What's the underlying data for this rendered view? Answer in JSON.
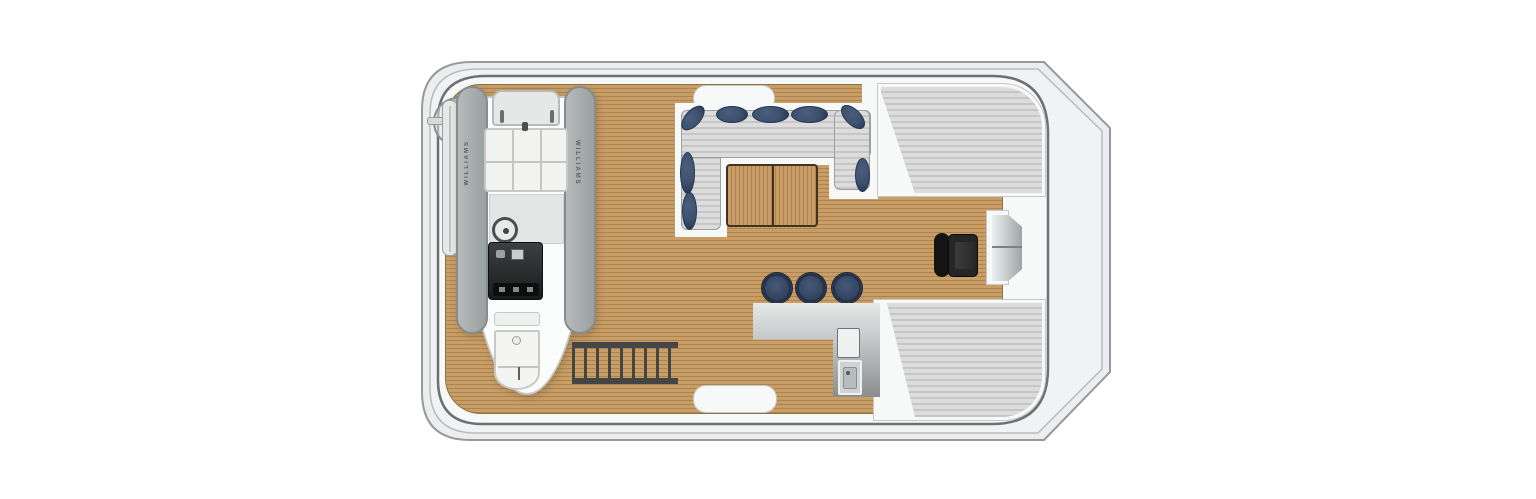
{
  "meta": {
    "description": "Top-down floor plan of a motor-yacht tender / sun deck",
    "view": "plan-view"
  },
  "palette": {
    "teak": "#c99e66",
    "teak_line": "#ad8450",
    "hull_fill": "#ecedee",
    "hull_line": "#97999c",
    "mid_fill": "#f1f2f3",
    "deck_fill": "#f7f8f8",
    "deck_line": "#6e7173",
    "pad_light": "#dcdcdc",
    "pad_dark": "#c6c6c6",
    "navy": "#3c4f6d",
    "navy_dark": "#263650",
    "steel_dark": "#8a8e8e",
    "chair_black": "#1c1c1c",
    "boat_white": "#fbfcfc",
    "boat_line": "#c3c6c6"
  },
  "tender": {
    "brand": "WILLIAMS"
  },
  "features": {
    "stool_count": 3,
    "sunpad_count": 2,
    "dinette_table_leaves": 2,
    "stair_tread_count": 9,
    "boarding_pad_count": 2
  }
}
